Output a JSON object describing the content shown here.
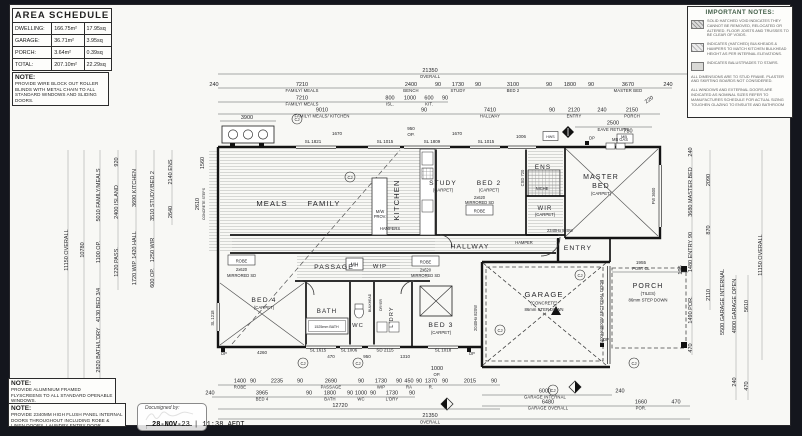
{
  "colors": {
    "paper": "#f8f8f5",
    "background": "#14161d",
    "ink": "#222222",
    "notes_title_green": "#44604a"
  },
  "area_schedule": {
    "title": "AREA SCHEDULE",
    "rows": [
      [
        "DWELLING:",
        "166.75m²",
        "17.95sq"
      ],
      [
        "GARAGE:",
        "36.71m²",
        "3.95sq"
      ],
      [
        "PORCH:",
        "3.64m²",
        "0.39sq"
      ],
      [
        "TOTAL:",
        "207.10m²",
        "22.29sq"
      ]
    ]
  },
  "notes": {
    "blinds_title": "NOTE:",
    "blinds": "PROVIDE WIRE BLOCK OUT ROLLER BLINDS WITH METAL CHAIN TO ALL STANDARD WINDOWS AND SLIDING DOORS.",
    "fly_title": "NOTE:",
    "fly": "PROVIDE ALUMINIUM FRAMED FLYSCREENS TO ALL STANDARD OPENABLE WINDOWS.",
    "doors_title": "NOTE:",
    "doors": "PROVIDE 2340MM HIGH FLUSH PANEL INTERNAL DOORS THROUGHOUT INCLUDING ROBE & LINEN DOORS, LAUNDRY ENTRY DOOR."
  },
  "important_notes": {
    "title": "IMPORTANT NOTES:",
    "items": [
      "SOLID HATCHED VOID INDICATES THEY CANNOT BE REMOVED, RELOCATED OR ALTERED. FLOOR JOISTS AND TRUSSES TO BE CLEAR OF VOIDS.",
      "INDICATES (HATCHED) BULKHEADS & HAMPERS TO MATCH KITCHEN BULKHEAD HEIGHT AS PER INTERNAL ELEVATIONS.",
      "INDICATES BALUSTRADES TO STAIRS.",
      "ALL DIMENSIONS ARE TO STUD FRAME. PLASTER AND SKIRTING BOARDS NOT CONSIDERED.",
      "ALL WINDOWS AND EXTERNAL DOORS ARE INDICATED AS NOMINAL SIZES REFER TO MANUFACTURES SCHEDULE FOR ACTUAL SIZING TOUGHEN GLAZING TO ENSUITE AND BATHROOM"
    ]
  },
  "rooms": {
    "meals": "MEALS",
    "family": "FAMILY",
    "kitchen": "KITCHEN",
    "study": "STUDY",
    "study_sub": "(CARPET)",
    "bed2": "BED 2",
    "bed2_sub": "(CARPET)",
    "ens": "ENS",
    "wir": "WIR",
    "wir_sub": "(CARPET)",
    "master1": "MASTER",
    "master2": "BED",
    "master_sub": "(CARPET)",
    "hallway": "HALLWAY",
    "entry": "ENTRY",
    "passage": "PASSAGE",
    "wip": "WIP",
    "bed4": "BED 4",
    "bed4_sub": "(CARPET)",
    "bath": "BATH",
    "wc": "WC",
    "ldry": "L'DRY",
    "bed3": "BED 3",
    "bed3_sub": "(CARPET)",
    "garage": "GARAGE",
    "garage_sub": "(CONCRETE)",
    "garage_step": "86mm STEP DOWN",
    "porch": "PORCH",
    "porch_sub": "(TILES)",
    "porch_step": "86mm STEP DOWN"
  },
  "labels": {
    "mw": "M/W",
    "prov": "PROV.",
    "hampers": "HAMPERS",
    "hamper": "HAMPER",
    "mh": "MH",
    "niche": "NICHE",
    "robe": "ROBE",
    "mirr1": "2x620",
    "mirr2": "MIRRORED SD",
    "mbgas": "MB GAS",
    "dp": "DP",
    "hws": "HWS",
    "mb": "MB",
    "cj": "CJ",
    "tub": "1525mm BATH",
    "bulkhead": "BULKHEAD",
    "dryer": "DRYER",
    "postcl1": "1955",
    "postcl2": "POST CL",
    "sect": "2400Hx4800W SECTIONAL DOOR",
    "door_g": "2040Hx 820W",
    "door_e": "2340Hx 820W",
    "csd": "CSD 720",
    "fw": "FW 3600",
    "sl1218": "SL 1218",
    "steps1": "CONCRETE STEPS",
    "win_top": [
      "SL 1821",
      "1670",
      "SL 1015",
      "950",
      "OP.",
      "SL 1809",
      "SL 1015",
      "1006"
    ],
    "win_bot": [
      "4260",
      "SL 1615",
      "470",
      "SL 1006",
      "950",
      "SD 2115",
      "1310",
      "SL 1018"
    ]
  },
  "dims": {
    "t1v": "21350",
    "t1l": "OVERALL",
    "t2": [
      [
        "240",
        ""
      ],
      [
        "7210",
        "FAMILY/ MEALS"
      ],
      [
        "2400",
        "BENCH"
      ],
      [
        "90",
        ""
      ],
      [
        "1730",
        "STUDY"
      ],
      [
        "90",
        ""
      ],
      [
        "3100",
        "BED 2"
      ],
      [
        "90",
        ""
      ],
      [
        "1800",
        ""
      ],
      [
        "90",
        ""
      ],
      [
        "3670",
        "MASTER BED"
      ],
      [
        "240",
        ""
      ]
    ],
    "t3": [
      [
        "7210",
        "FAMILY/ MEALS"
      ],
      [
        "800",
        "ISL."
      ],
      [
        "1000",
        ""
      ],
      [
        "600",
        "KIT."
      ],
      [
        "90",
        ""
      ]
    ],
    "t4": [
      [
        "9010",
        "FAMILY/ MEALS/ KITCHEN"
      ],
      [
        "90",
        ""
      ],
      [
        "7410",
        "HALLWAY"
      ],
      [
        "90",
        ""
      ],
      [
        "2120",
        "ENTRY"
      ],
      [
        "240",
        ""
      ],
      [
        "2150",
        "PORCH"
      ]
    ],
    "t5a": "3900",
    "t5b_v": "2500",
    "t5b_l": "EAVE RETURN",
    "t5c": "730",
    "t5d": "220",
    "bA": [
      [
        "1400",
        "ROBE"
      ],
      [
        "90",
        ""
      ],
      [
        "2235",
        ""
      ],
      [
        "90",
        ""
      ],
      [
        "2690",
        "PASSAGE"
      ],
      [
        "90",
        ""
      ],
      [
        "1730",
        "WIP"
      ],
      [
        "90",
        ""
      ],
      [
        "450",
        "RA"
      ],
      [
        "90",
        ""
      ],
      [
        "1370",
        "R."
      ],
      [
        "90",
        ""
      ],
      [
        "2015",
        ""
      ],
      [
        "90",
        ""
      ]
    ],
    "bB": [
      [
        "240",
        ""
      ],
      [
        "3965",
        "BED 4"
      ],
      [
        "90",
        ""
      ],
      [
        "1800",
        "BATH"
      ],
      [
        "90",
        ""
      ],
      [
        "1000",
        "WC"
      ],
      [
        "90",
        ""
      ],
      [
        "1730",
        "L'DRY"
      ],
      [
        "90",
        ""
      ]
    ],
    "bC": "12720",
    "bDv": "21350",
    "bDl": "OVERALL",
    "bOPv": "1000",
    "bOPl": "OP.",
    "g1": [
      [
        "6000",
        "GARAGE INTERNAL"
      ],
      [
        "240",
        ""
      ]
    ],
    "g2": [
      [
        "6480",
        "GARAGE OVERALL"
      ],
      [
        "1660",
        "POR."
      ],
      [
        "470",
        ""
      ]
    ],
    "left": [
      "11150 OVERALL",
      "10780",
      "5010 FAMILY/MEALS",
      "1100 OP.",
      "4130 BED 3/4",
      "2820 BATH/L'DRY",
      "1370",
      "920",
      "2400 ISLAND",
      "1220 PASS.",
      "3690 KITCHEN",
      "1420 HALL",
      "1720 WIP",
      "3510 STUDY/BED 2",
      "1250 WIR",
      "600 OP.",
      "2140 ENS",
      "2640",
      "2610",
      "1560"
    ],
    "right": [
      "240",
      "3680 MASTER BED",
      "90",
      "1480 ENTRY",
      "1490 POR.",
      "470",
      "2090",
      "870",
      "2110",
      "195",
      "5500 GARAGE INTERNAL",
      "4800 GARAGE OPEN",
      "5610",
      "11150 OVERALL",
      "240",
      "470"
    ]
  },
  "footer": {
    "signed_by": "Docusigned by:",
    "date_bold": "28-NOV-",
    "date_rest": "23 | 11:38 AEDT"
  }
}
